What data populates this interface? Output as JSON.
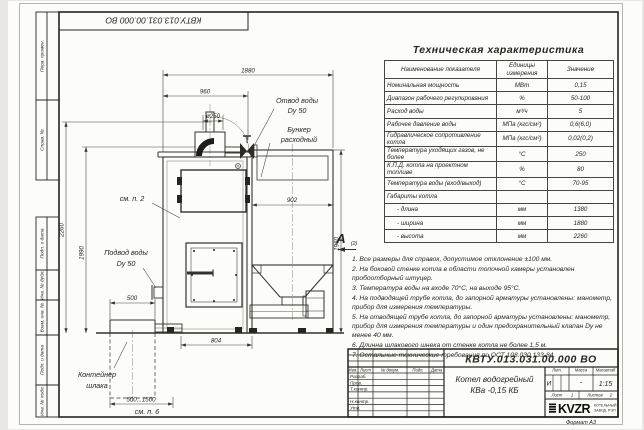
{
  "page": {
    "designation_top": "КВТУ.013.031.00.000 ВО",
    "format_label": "Формат А3"
  },
  "side_stamp": {
    "perv_primen": "Перв. примен.",
    "sprav_no": "Справ. №",
    "podp_data_1": "Подп. и дата",
    "inv_dubl": "Инв. № дубл.",
    "vzam_inv": "Взам. инв. №",
    "podp_data_2": "Подп. и дата",
    "inv_podl": "Инв. № подл."
  },
  "tech_table": {
    "title": "Техническая характеристика",
    "headers": {
      "name": "Наименование показателя",
      "unit": "Единицы измерения",
      "value": "Значение"
    },
    "rows": [
      {
        "name": "Номинальная мощность",
        "unit": "МВт",
        "value": "0,15"
      },
      {
        "name": "Диапазон рабочего регулирования",
        "unit": "%",
        "value": "50-100"
      },
      {
        "name": "Расход воды",
        "unit": "м³/ч",
        "value": "5"
      },
      {
        "name": "Рабочее давление воды",
        "unit": "МПа (кгс/см²)",
        "value": "0,6(6,0)"
      },
      {
        "name": "Гидравлическое сопротивление котла",
        "unit": "МПа (кгс/см²)",
        "value": "0,02(0,2)"
      },
      {
        "name": "Температура уходящих газов, не более",
        "unit": "°С",
        "value": "250"
      },
      {
        "name": "К.П.Д. котла на проектном топливе",
        "unit": "%",
        "value": "80"
      },
      {
        "name": "Температура воды (вход/выход)",
        "unit": "°С",
        "value": "70-95"
      },
      {
        "name": "Габариты котла",
        "unit": "",
        "value": ""
      },
      {
        "name": "- длина",
        "unit": "мм",
        "value": "1380"
      },
      {
        "name": "- ширина",
        "unit": "мм",
        "value": "1880"
      },
      {
        "name": "- высота",
        "unit": "мм",
        "value": "2260"
      }
    ]
  },
  "view_label": {
    "letter": "А",
    "ref": "(2)"
  },
  "notes": [
    "1.  Все размеры для справок, допустимое отклонение ±100 мм.",
    "2.  На боковой стенке котла в области топочной камеры установлен пробоотборный штуцер.",
    "3.  Температура воды на входе 70°С, на выходе 95°С.",
    "4.  На подводящей трубе котла, до запорной арматуры установлены: манометр, прибор для измерения температуры.",
    "5.  На отводящей трубе котла, до запорной арматуры установлены: манометр, прибор для измерения температуры и один предохранительный клапан Dу не менее 40 мм.",
    "6.  Длинна шлакового шнека от стенке котла не более 1,5 м.",
    "7.  Остальные технические требования по ОСТ 108.030.133-84."
  ],
  "drawing": {
    "dims": {
      "d1880": "1880",
      "d960": "960",
      "d250": "ø250",
      "d2260": "2260",
      "d1990": "1990",
      "d902": "902",
      "d1960": "1960",
      "d500": "500",
      "d804": "804",
      "d500_1500": "500...1500"
    },
    "labels": {
      "otvod_1": "Отвод воды",
      "otvod_2": "Dy 50",
      "bunker_1": "Бункер",
      "bunker_2": "расходный",
      "sm_p2": "см. п. 2",
      "podvod_1": "Подвод воды",
      "podvod_2": "Dy 50",
      "container_1": "Контейнер",
      "container_2": "шлака",
      "sm_p6": "см. п. 6"
    }
  },
  "title_block": {
    "doc_number": "КВТУ.013.031.00.000 ВО",
    "product_1": "Котел водогрейный",
    "product_2": "КВа -0,15  КБ",
    "col_izm": "Изм.",
    "col_list": "Лист",
    "col_dokum": "№ докум.",
    "col_podp": "Подп.",
    "col_data": "Дата",
    "row_razrab": "Разраб.",
    "row_prov": "Пров.",
    "row_tkontr": "Т.контр.",
    "row_nkontr": "Н.контр.",
    "row_utv": "Утв.",
    "lit_header": "Лит.",
    "massa_header": "Масса",
    "masshtab_header": "Масштаб",
    "lit_value": "И",
    "massa_value": "-",
    "masshtab_value": "1:15",
    "list_label": "Лист",
    "list_value": "1",
    "listov_label": "Листов",
    "listov_value": "2",
    "logo_text": "KVZR",
    "logo_sub_1": "КОТЕЛЬНЫЙ",
    "logo_sub_2": "ЗАВОД. РЭП"
  }
}
